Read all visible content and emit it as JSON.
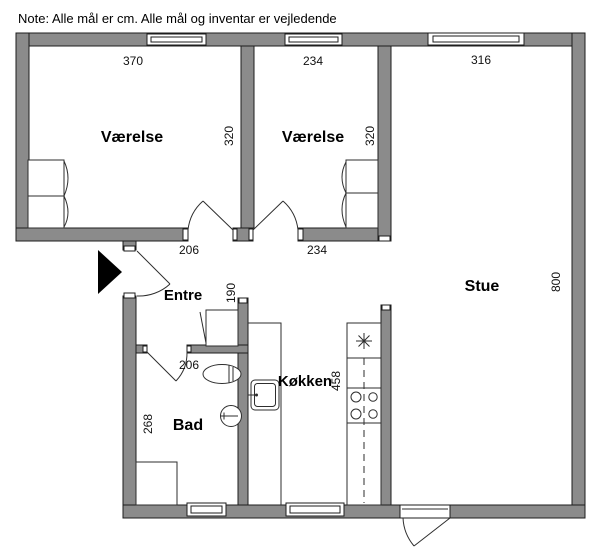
{
  "note": "Note: Alle mål er cm. Alle mål og inventar er vejledende",
  "colors": {
    "background": "#ffffff",
    "wall_fill": "#8b8b8b",
    "wall_stroke": "#1c1c1c",
    "line": "#2e2e2e",
    "entrance_arrow": "#000000"
  },
  "rooms": {
    "vaerelse_1": {
      "label": "Værelse",
      "width_cm": "370",
      "depth_cm": "320"
    },
    "vaerelse_2": {
      "label": "Værelse",
      "width_cm": "234",
      "depth_cm": "320"
    },
    "stue": {
      "label": "Stue",
      "width_cm": "316",
      "depth_cm": "800"
    },
    "entre": {
      "label": "Entre",
      "width_cm": "206",
      "closet_depth_cm": "190"
    },
    "koekken": {
      "label": "Køkken",
      "width_cm": "234",
      "depth_cm": "458"
    },
    "bad": {
      "label": "Bad",
      "width_cm": "206",
      "depth_cm": "268"
    }
  },
  "fixtures": {
    "entrance_arrow": "entrance-direction-arrow",
    "wardrobe_1": "wardrobe-with-doors",
    "wardrobe_2": "wardrobe-with-doors",
    "entre_closet": "hall-closet",
    "toilet": "toilet",
    "bad_sink": "washbasin",
    "shower": "shower-tray",
    "kitchen_sink": "kitchen-sink",
    "stove": "stove-four-burners",
    "counter_symbol": "star-symbol",
    "windows": "window",
    "balcony_door": "balcony-door"
  }
}
